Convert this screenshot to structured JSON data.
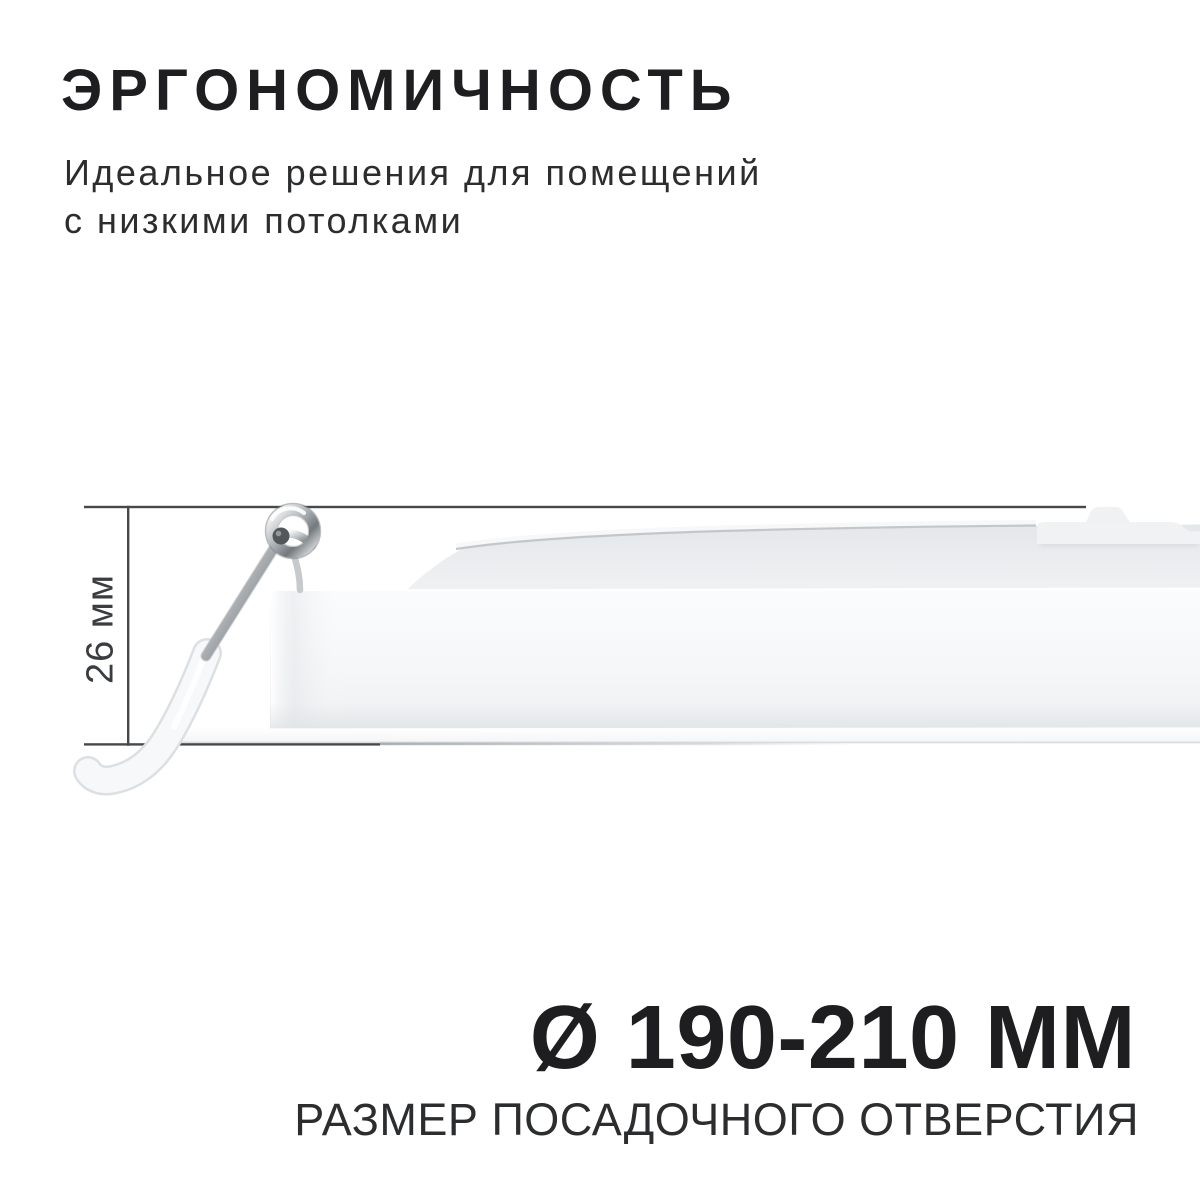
{
  "page": {
    "background": "#ffffff"
  },
  "header": {
    "title": "ЭРГОНОМИЧНОСТЬ",
    "subtitle_lines": [
      "Идеальное решения для помещений",
      "с низкими потолками"
    ]
  },
  "diagram": {
    "height_label": "26 мм"
  },
  "footer": {
    "value": "Ø 190-210 ММ",
    "caption": "РАЗМЕР ПОСАДОЧНОГО ОТВЕРСТИЯ"
  },
  "colors": {
    "text_primary": "#1e1e20",
    "text_secondary": "#2c2d2e",
    "dimension_line": "#46494c",
    "lamp_white": "#f4f6f7",
    "chrome": "#b7bbbe"
  }
}
